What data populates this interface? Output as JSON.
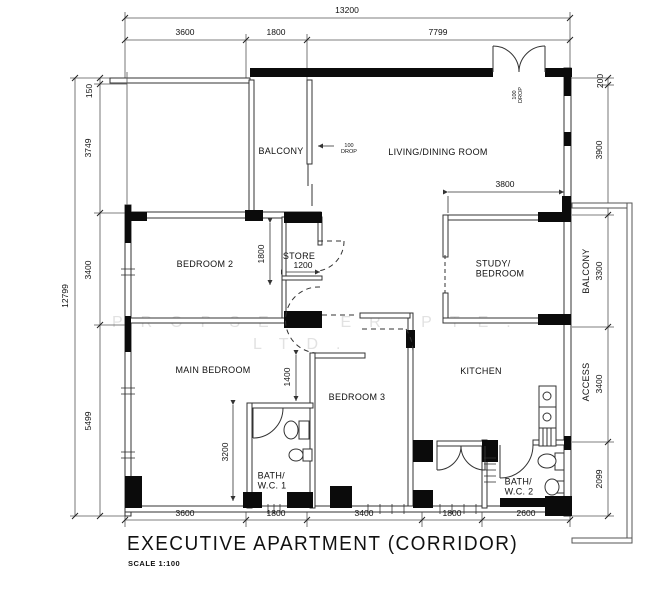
{
  "title": {
    "main": "EXECUTIVE APARTMENT (CORRIDOR)",
    "scale": "SCALE 1:100"
  },
  "watermark": {
    "line1": "PROPSELLER PTE.",
    "line2": "LTD."
  },
  "rooms": {
    "balcony_top": "BALCONY",
    "living_dining": "LIVING/DINING ROOM",
    "bedroom2": "BEDROOM 2",
    "store": "STORE",
    "study_bedroom": "STUDY/\nBEDROOM",
    "main_bedroom": "MAIN BEDROOM",
    "bedroom3": "BEDROOM 3",
    "kitchen": "KITCHEN",
    "bath_wc1": "BATH/\nW.C. 1",
    "bath_wc2": "BATH/\nW.C. 2",
    "balcony_right": "BALCONY",
    "access": "ACCESS"
  },
  "dims": {
    "top_total": "13200",
    "top": [
      "3600",
      "1800",
      "7799"
    ],
    "left_total": "12799",
    "left": [
      "150",
      "3749",
      "3400",
      "5499"
    ],
    "right": [
      "200",
      "3900",
      "3300",
      "3400",
      "2099"
    ],
    "bottom": [
      "3600",
      "1800",
      "3400",
      "1800",
      "2600"
    ],
    "study_width": "3800",
    "store_height": "1800",
    "store_width": "1200",
    "bath1_offset": "1400",
    "bath1_length": "3200",
    "balcony_drop": "100\nDROP",
    "entry_drop": "100\nDROP"
  }
}
